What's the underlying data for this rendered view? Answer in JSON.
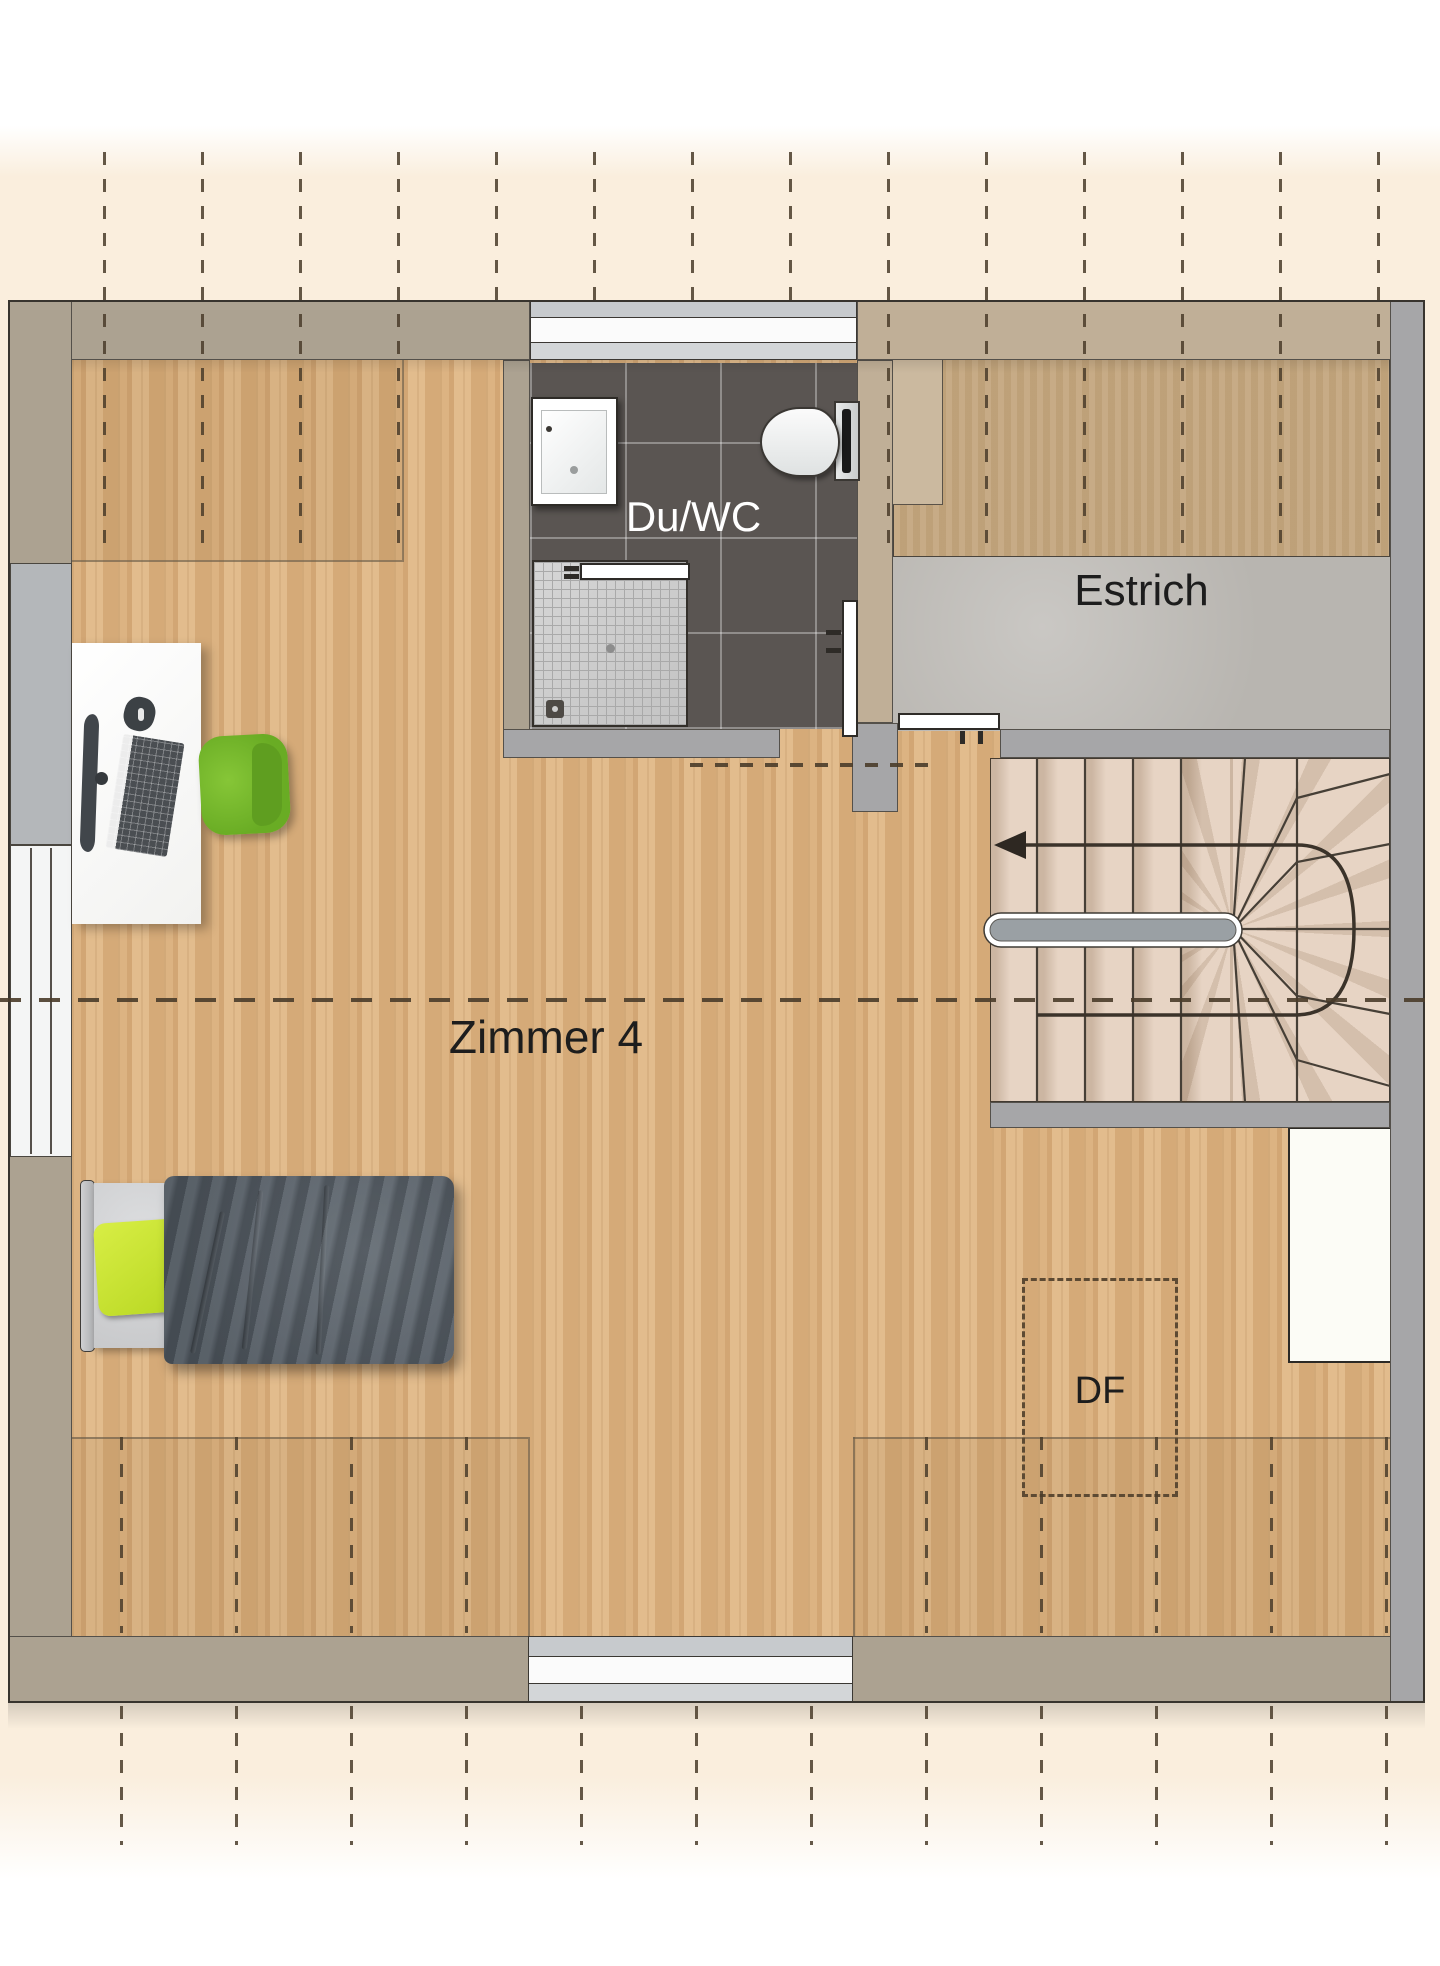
{
  "plan": {
    "title": "Dachgeschoss Grundriss",
    "labels": {
      "room": "Zimmer 4",
      "bath": "Du/WC",
      "attic": "Estrich",
      "roof_window": "DF"
    },
    "colors": {
      "cream": "#faeedd",
      "wood": "#d9b07e",
      "wall": "#aca291",
      "wall_tan": "#c0af97",
      "wall_gray": "#a6a6a8",
      "tile": "#5a5552",
      "kraft": "#c4a77f",
      "screed": "#b8b5b0",
      "tread": "#e7d4c4",
      "chair_green": "#72b32a",
      "pillow_green": "#c6e234",
      "blanket_gray": "#5c646c",
      "dash": "#4a3c2a"
    },
    "icons": {
      "stair_direction": "arrow-left-icon"
    }
  }
}
